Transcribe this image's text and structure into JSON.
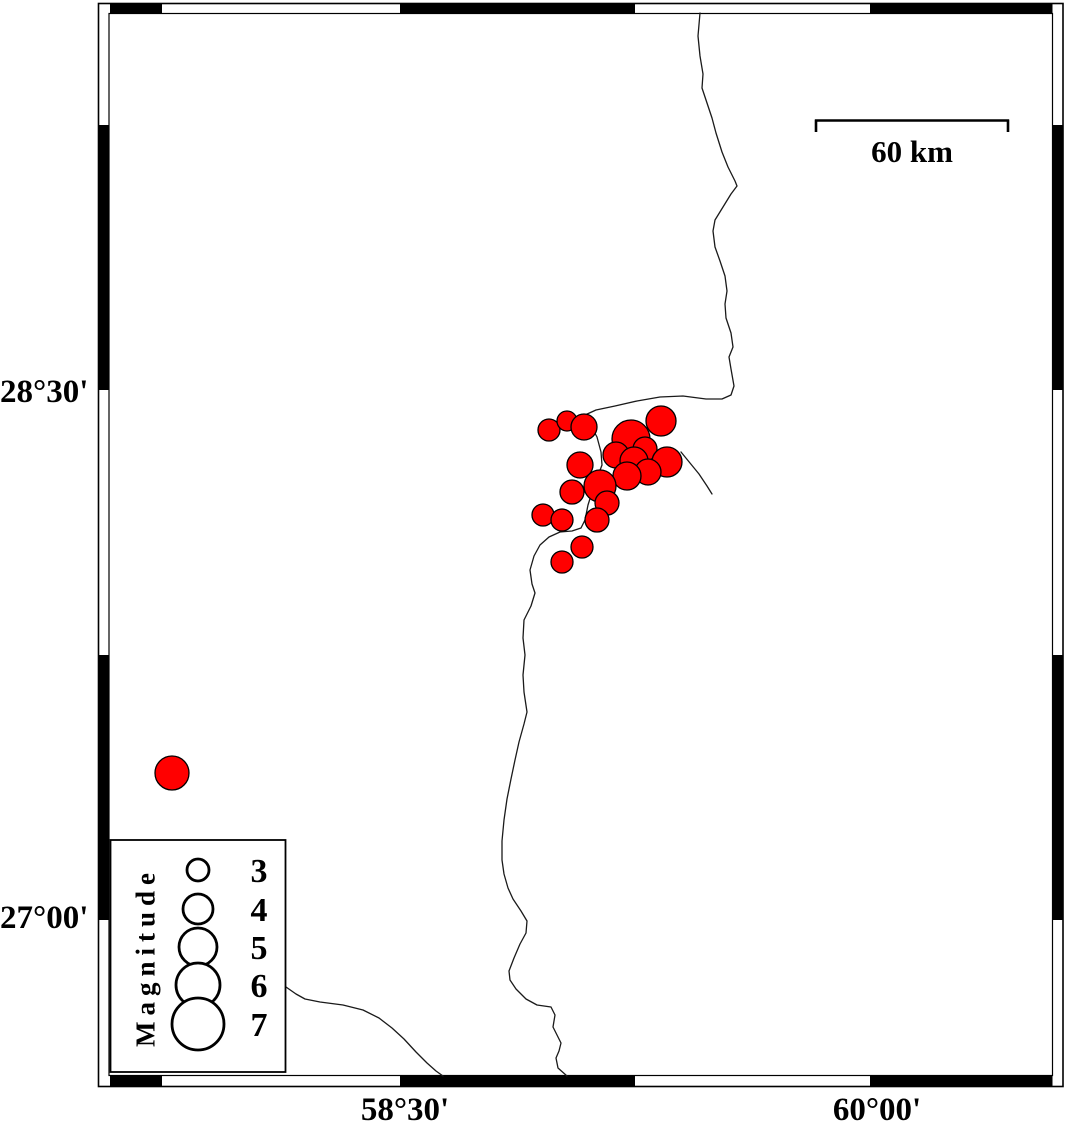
{
  "figure": {
    "type": "seismicity-map",
    "description": "Epicenter map with magnitude-scaled red circles, fancy checkered map frame, scale bar and magnitude legend"
  },
  "frame": {
    "lat_labels": [
      {
        "text": "28°30'",
        "y": 392
      },
      {
        "text": "27°00'",
        "y": 918
      }
    ],
    "lon_labels": [
      {
        "text": "58°30'",
        "x": 405
      },
      {
        "text": "60°00'",
        "x": 877
      }
    ]
  },
  "scale_bar": {
    "label": "60 km"
  },
  "legend": {
    "title": "Magnitude",
    "entries": [
      {
        "label": "3",
        "radius": 11,
        "cy": 870
      },
      {
        "label": "4",
        "radius": 15,
        "cy": 909
      },
      {
        "label": "5",
        "radius": 19,
        "cy": 947
      },
      {
        "label": "6",
        "radius": 22,
        "cy": 985
      },
      {
        "label": "7",
        "radius": 26,
        "cy": 1024
      }
    ]
  },
  "colors": {
    "event_fill": "#ff0000",
    "event_stroke": "#000000",
    "line": "#1a1a1a",
    "frame": "#000000"
  },
  "earthquakes": [
    {
      "x": 549,
      "y": 430,
      "r": 11
    },
    {
      "x": 567,
      "y": 421,
      "r": 10
    },
    {
      "x": 584,
      "y": 427,
      "r": 13
    },
    {
      "x": 661,
      "y": 421,
      "r": 15
    },
    {
      "x": 631,
      "y": 439,
      "r": 19
    },
    {
      "x": 645,
      "y": 449,
      "r": 12
    },
    {
      "x": 667,
      "y": 462,
      "r": 15
    },
    {
      "x": 616,
      "y": 455,
      "r": 13
    },
    {
      "x": 634,
      "y": 461,
      "r": 14
    },
    {
      "x": 580,
      "y": 465,
      "r": 13
    },
    {
      "x": 648,
      "y": 472,
      "r": 13
    },
    {
      "x": 627,
      "y": 476,
      "r": 14
    },
    {
      "x": 600,
      "y": 486,
      "r": 16
    },
    {
      "x": 572,
      "y": 492,
      "r": 12
    },
    {
      "x": 607,
      "y": 503,
      "r": 12
    },
    {
      "x": 543,
      "y": 515,
      "r": 11
    },
    {
      "x": 562,
      "y": 520,
      "r": 11
    },
    {
      "x": 597,
      "y": 520,
      "r": 12
    },
    {
      "x": 582,
      "y": 547,
      "r": 11
    },
    {
      "x": 562,
      "y": 562,
      "r": 11
    },
    {
      "x": 172,
      "y": 773,
      "r": 17
    }
  ],
  "map_lines": {
    "main": [
      [
        700,
        13
      ],
      [
        698,
        36
      ],
      [
        700,
        56
      ],
      [
        703,
        74
      ],
      [
        702,
        88
      ],
      [
        707,
        103
      ],
      [
        712,
        118
      ],
      [
        716,
        133
      ],
      [
        722,
        152
      ],
      [
        728,
        167
      ],
      [
        735,
        181
      ],
      [
        737,
        186
      ],
      [
        731,
        194
      ],
      [
        723,
        207
      ],
      [
        715,
        220
      ],
      [
        713,
        231
      ],
      [
        715,
        247
      ],
      [
        720,
        261
      ],
      [
        725,
        276
      ],
      [
        727,
        291
      ],
      [
        725,
        304
      ],
      [
        726,
        318
      ],
      [
        731,
        333
      ],
      [
        733,
        347
      ],
      [
        729,
        357
      ],
      [
        731,
        369
      ],
      [
        734,
        386
      ],
      [
        731,
        395
      ],
      [
        722,
        399
      ],
      [
        706,
        399
      ],
      [
        683,
        396
      ],
      [
        660,
        397
      ],
      [
        637,
        401
      ],
      [
        615,
        406
      ],
      [
        596,
        410
      ],
      [
        585,
        415
      ],
      [
        591,
        426
      ],
      [
        597,
        437
      ],
      [
        601,
        452
      ],
      [
        602,
        465
      ],
      [
        599,
        473
      ],
      [
        594,
        486
      ],
      [
        588,
        505
      ],
      [
        585,
        520
      ],
      [
        581,
        528
      ],
      [
        572,
        531
      ],
      [
        560,
        532
      ],
      [
        549,
        537
      ],
      [
        540,
        545
      ],
      [
        534,
        556
      ],
      [
        530,
        570
      ],
      [
        532,
        584
      ],
      [
        535,
        593
      ],
      [
        531,
        606
      ],
      [
        524,
        620
      ],
      [
        523,
        638
      ],
      [
        525,
        655
      ],
      [
        523,
        675
      ],
      [
        524,
        692
      ],
      [
        527,
        712
      ],
      [
        524,
        724
      ],
      [
        519,
        742
      ],
      [
        515,
        760
      ],
      [
        511,
        779
      ],
      [
        507,
        799
      ],
      [
        504,
        820
      ],
      [
        502,
        841
      ],
      [
        502,
        860
      ],
      [
        504,
        874
      ],
      [
        508,
        888
      ],
      [
        513,
        899
      ],
      [
        521,
        911
      ],
      [
        527,
        921
      ],
      [
        526,
        933
      ],
      [
        520,
        944
      ],
      [
        514,
        958
      ],
      [
        509,
        971
      ],
      [
        510,
        980
      ],
      [
        516,
        989
      ],
      [
        526,
        999
      ],
      [
        537,
        1005
      ],
      [
        551,
        1007
      ],
      [
        555,
        1015
      ],
      [
        553,
        1027
      ],
      [
        557,
        1035
      ],
      [
        561,
        1043
      ],
      [
        559,
        1051
      ],
      [
        556,
        1058
      ],
      [
        558,
        1068
      ],
      [
        567,
        1076
      ]
    ],
    "branch": [
      [
        286,
        987
      ],
      [
        296,
        994
      ],
      [
        305,
        999
      ],
      [
        320,
        1002
      ],
      [
        343,
        1005
      ],
      [
        363,
        1010
      ],
      [
        379,
        1018
      ],
      [
        392,
        1028
      ],
      [
        404,
        1039
      ],
      [
        416,
        1052
      ],
      [
        427,
        1063
      ],
      [
        436,
        1071
      ],
      [
        443,
        1076
      ]
    ],
    "stub": [
      [
        681,
        452
      ],
      [
        690,
        463
      ],
      [
        699,
        474
      ],
      [
        707,
        486
      ],
      [
        712,
        494
      ]
    ]
  }
}
